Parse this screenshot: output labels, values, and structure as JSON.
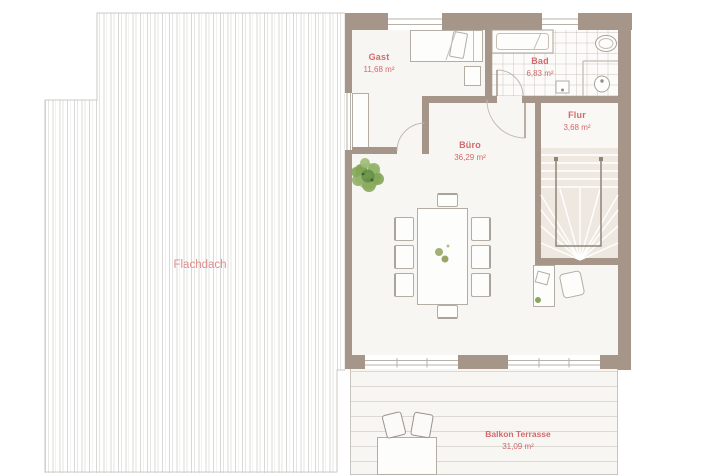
{
  "plan_title": "floor-plan-upper-storey",
  "rooms": [
    {
      "name": "Gast",
      "area": "11,68 m²"
    },
    {
      "name": "Bad",
      "area": "6,83 m²"
    },
    {
      "name": "Flur",
      "area": "3,68 m²"
    },
    {
      "name": "Büro",
      "area": "36,29 m²"
    },
    {
      "name": "Balkon Terrasse",
      "area": "31,09 m²"
    },
    {
      "name": "Flachdach",
      "area": ""
    }
  ],
  "colors": {
    "wall": "#a59689",
    "label": "#d2696b",
    "flachdach": "#e08d8d",
    "floor": "#f8f6f3",
    "stairs": "#eee8e1",
    "plant": "#7ba050"
  }
}
